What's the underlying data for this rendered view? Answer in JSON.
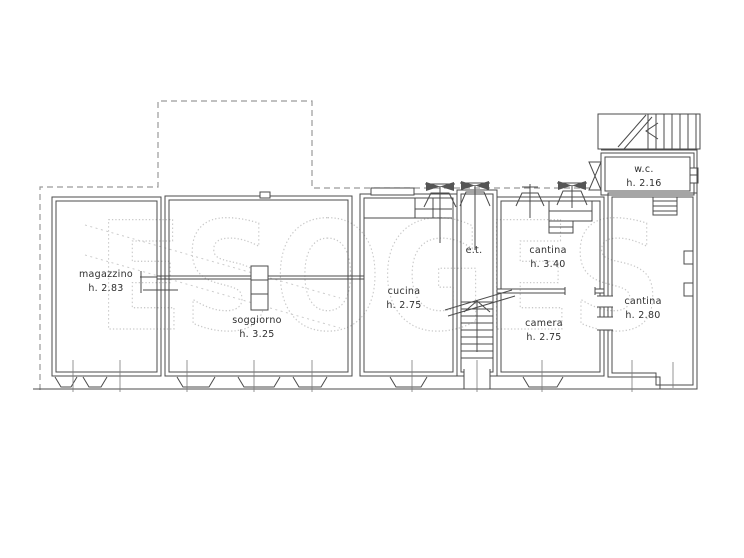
{
  "watermark": "ESOGES",
  "rooms": [
    {
      "id": "magazzino",
      "name": "magazzino",
      "height": "h. 2.83"
    },
    {
      "id": "soggiorno",
      "name": "soggiorno",
      "height": "h. 3.25"
    },
    {
      "id": "cucina",
      "name": "cucina",
      "height": "h. 2.75"
    },
    {
      "id": "et",
      "name": "e.t.",
      "height": ""
    },
    {
      "id": "cantina-1",
      "name": "cantina",
      "height": "h. 3.40"
    },
    {
      "id": "camera",
      "name": "camera",
      "height": "h. 2.75"
    },
    {
      "id": "wc",
      "name": "w.c.",
      "height": "h. 2.16"
    },
    {
      "id": "cantina-2",
      "name": "cantina",
      "height": "h. 2.80"
    }
  ],
  "colors": {
    "wall_line": "#4b4b4b",
    "dashed_boundary": "#9a9a9a",
    "watermark": "#c9c9c9",
    "background": "#ffffff"
  }
}
